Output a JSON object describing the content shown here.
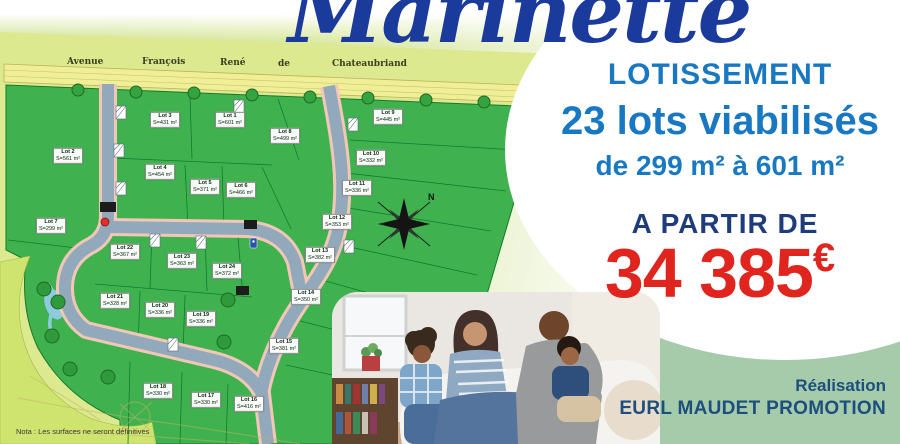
{
  "title": "Marinette",
  "promo": {
    "lotissement": "LOTISSEMENT",
    "lots_line": "23 lots viabilisés",
    "surface_line": "de 299 m² à 601 m²",
    "from_label": "A PARTIR DE",
    "price": "34 385",
    "currency": "€",
    "realisation": "Réalisation",
    "company": "EURL MAUDET PROMOTION"
  },
  "plan": {
    "street_words": [
      "Avenue",
      "François",
      "René",
      "de",
      "Chateaubriand"
    ],
    "note": "Nota : Les surfaces ne seront définitives",
    "compass_n": "N",
    "lots": [
      {
        "name": "Lot 1",
        "surface": "S=601 m²",
        "x": 230,
        "y": 120
      },
      {
        "name": "Lot 2",
        "surface": "S=561 m²",
        "x": 68,
        "y": 156
      },
      {
        "name": "Lot 3",
        "surface": "S=431 m²",
        "x": 165,
        "y": 120
      },
      {
        "name": "Lot 4",
        "surface": "S=454 m²",
        "x": 160,
        "y": 172
      },
      {
        "name": "Lot 5",
        "surface": "S=371 m²",
        "x": 205,
        "y": 187
      },
      {
        "name": "Lot 6",
        "surface": "S=466 m²",
        "x": 241,
        "y": 190
      },
      {
        "name": "Lot 7",
        "surface": "S=299 m²",
        "x": 51,
        "y": 226
      },
      {
        "name": "Lot 8",
        "surface": "S=499 m²",
        "x": 285,
        "y": 136
      },
      {
        "name": "Lot 9",
        "surface": "S=445 m²",
        "x": 388,
        "y": 117
      },
      {
        "name": "Lot 10",
        "surface": "S=332 m²",
        "x": 371,
        "y": 158
      },
      {
        "name": "Lot 11",
        "surface": "S=336 m²",
        "x": 357,
        "y": 188
      },
      {
        "name": "Lot 12",
        "surface": "S=353 m²",
        "x": 337,
        "y": 222
      },
      {
        "name": "Lot 13",
        "surface": "S=382 m²",
        "x": 320,
        "y": 255
      },
      {
        "name": "Lot 14",
        "surface": "S=350 m²",
        "x": 306,
        "y": 297
      },
      {
        "name": "Lot 15",
        "surface": "S=381 m²",
        "x": 284,
        "y": 346
      },
      {
        "name": "Lot 16",
        "surface": "S=416 m²",
        "x": 249,
        "y": 404
      },
      {
        "name": "Lot 17",
        "surface": "S=330 m²",
        "x": 206,
        "y": 400
      },
      {
        "name": "Lot 18",
        "surface": "S=330 m²",
        "x": 158,
        "y": 391
      },
      {
        "name": "Lot 19",
        "surface": "S=336 m²",
        "x": 201,
        "y": 319
      },
      {
        "name": "Lot 20",
        "surface": "S=336 m²",
        "x": 160,
        "y": 310
      },
      {
        "name": "Lot 21",
        "surface": "S=328 m²",
        "x": 115,
        "y": 301
      },
      {
        "name": "Lot 22",
        "surface": "S=367 m²",
        "x": 125,
        "y": 252
      },
      {
        "name": "Lot 23",
        "surface": "S=363 m²",
        "x": 182,
        "y": 261
      },
      {
        "name": "Lot 24",
        "surface": "S=372 m²",
        "x": 227,
        "y": 271
      }
    ]
  },
  "colors": {
    "title_blue": "#1a3a9c",
    "promo_blue": "#1878c2",
    "navy_blue": "#1e3c7c",
    "price_red": "#e0241e",
    "company_blue": "#1c4f7e",
    "map_lot_green": "#3fb24f",
    "map_backdrop": "#dce98e",
    "corner_green": "#a6cbaa"
  }
}
